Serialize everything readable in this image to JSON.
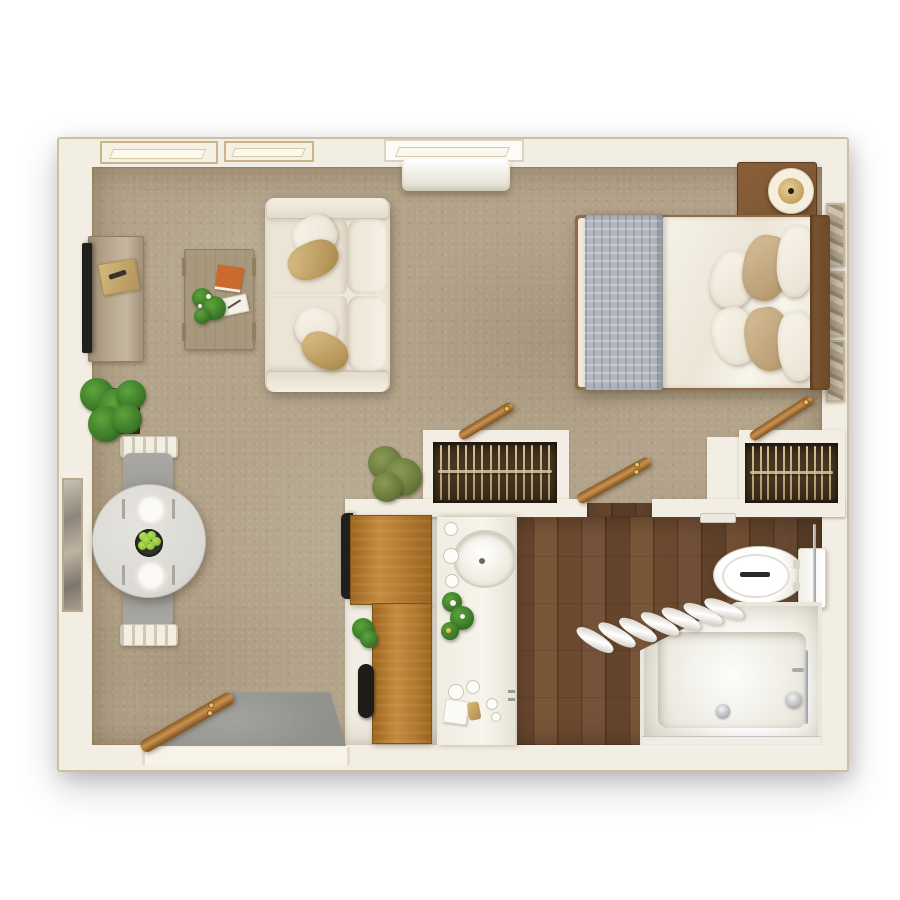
{
  "meta": {
    "title": "Top-down 3D rendered floor plan of a studio apartment with living area, bedroom, dining nook, kitchenette and bathroom",
    "view": "top-down 3D render",
    "visible_text": []
  },
  "palette": {
    "wall": "#f3eee3",
    "wallEdge": "#cdbfa2",
    "carpet": "#b3a38a",
    "woodFloor": "#6b4a30",
    "woodPlankLight": "#7a5638",
    "oak": "#b0772f",
    "oakDark": "#96601f",
    "closetBg": "#40311f",
    "hanger": "#d6c4a0",
    "fabric": "#f0ebe0",
    "gold": "#dcc289",
    "goldDark": "#aa8749",
    "tanPillow": "#d7c09a",
    "blanket": "#b2b7bf",
    "tableTop": "#dbd9d3",
    "chairGrey": "#9c9b97",
    "fixtureWhite": "#f2eee4",
    "fixtureLine": "#c9c7bf",
    "green": "#3c7a28",
    "greenDark": "#27541a",
    "olive": "#6b7a3c",
    "tvDark": "#211f1c",
    "chrome": "#b9bcbf",
    "mat": "#8f8f8b",
    "bookOrange": "#cc6a2e",
    "doorWood": "#c99250",
    "doorWoodDark": "#8a5a22",
    "headboard": "#6e4a2a",
    "nightstand": "#7a5636",
    "consoleWood": "#b5a48c",
    "coffeeWood": "#a8997e",
    "frameTan": "#c9b48c",
    "apple": "#8fc63a"
  },
  "rooms": {
    "living_room": {
      "items": [
        "tv-console",
        "flat-screen-tv",
        "gold-tray",
        "coffee-table",
        "orange-book",
        "white-notepad",
        "coffee-table-plant",
        "two-seat-sofa",
        "sofa-pillows",
        "floor-plant",
        "windows",
        "wall-ac-unit"
      ]
    },
    "bedroom": {
      "items": [
        "double-bed",
        "grey-folded-blanket",
        "white-duvet",
        "pillows",
        "wood-headboard",
        "nightstand",
        "round-table-lamp",
        "wall-art-frames"
      ]
    },
    "dining_nook": {
      "items": [
        "round-dining-table",
        "two-place-settings",
        "fruit-bowl",
        "two-grey-chairs",
        "tall-wall-mirror"
      ]
    },
    "kitchenette": {
      "items": [
        "oak-counter",
        "dark-appliance",
        "counter-plant",
        "dark-handle-appliance"
      ]
    },
    "bathroom": {
      "items": [
        "white-vanity",
        "round-sink",
        "flower-bouquet",
        "toiletries",
        "toilet",
        "towel-bar",
        "bathtub-shower",
        "folded-shower-curtain",
        "chrome-fixtures"
      ]
    },
    "hallway": {
      "items": [
        "left-closet",
        "right-closet",
        "open-wood-doors"
      ]
    },
    "entry": {
      "items": [
        "entry-door",
        "grey-door-mat"
      ]
    }
  },
  "closets": {
    "left": {
      "hangers": 14
    },
    "right": {
      "hangers": 11
    }
  },
  "dining": {
    "apples": 6,
    "place_settings": 2,
    "chairs": 2
  },
  "bathroom": {
    "curtain_pleats": 7
  }
}
